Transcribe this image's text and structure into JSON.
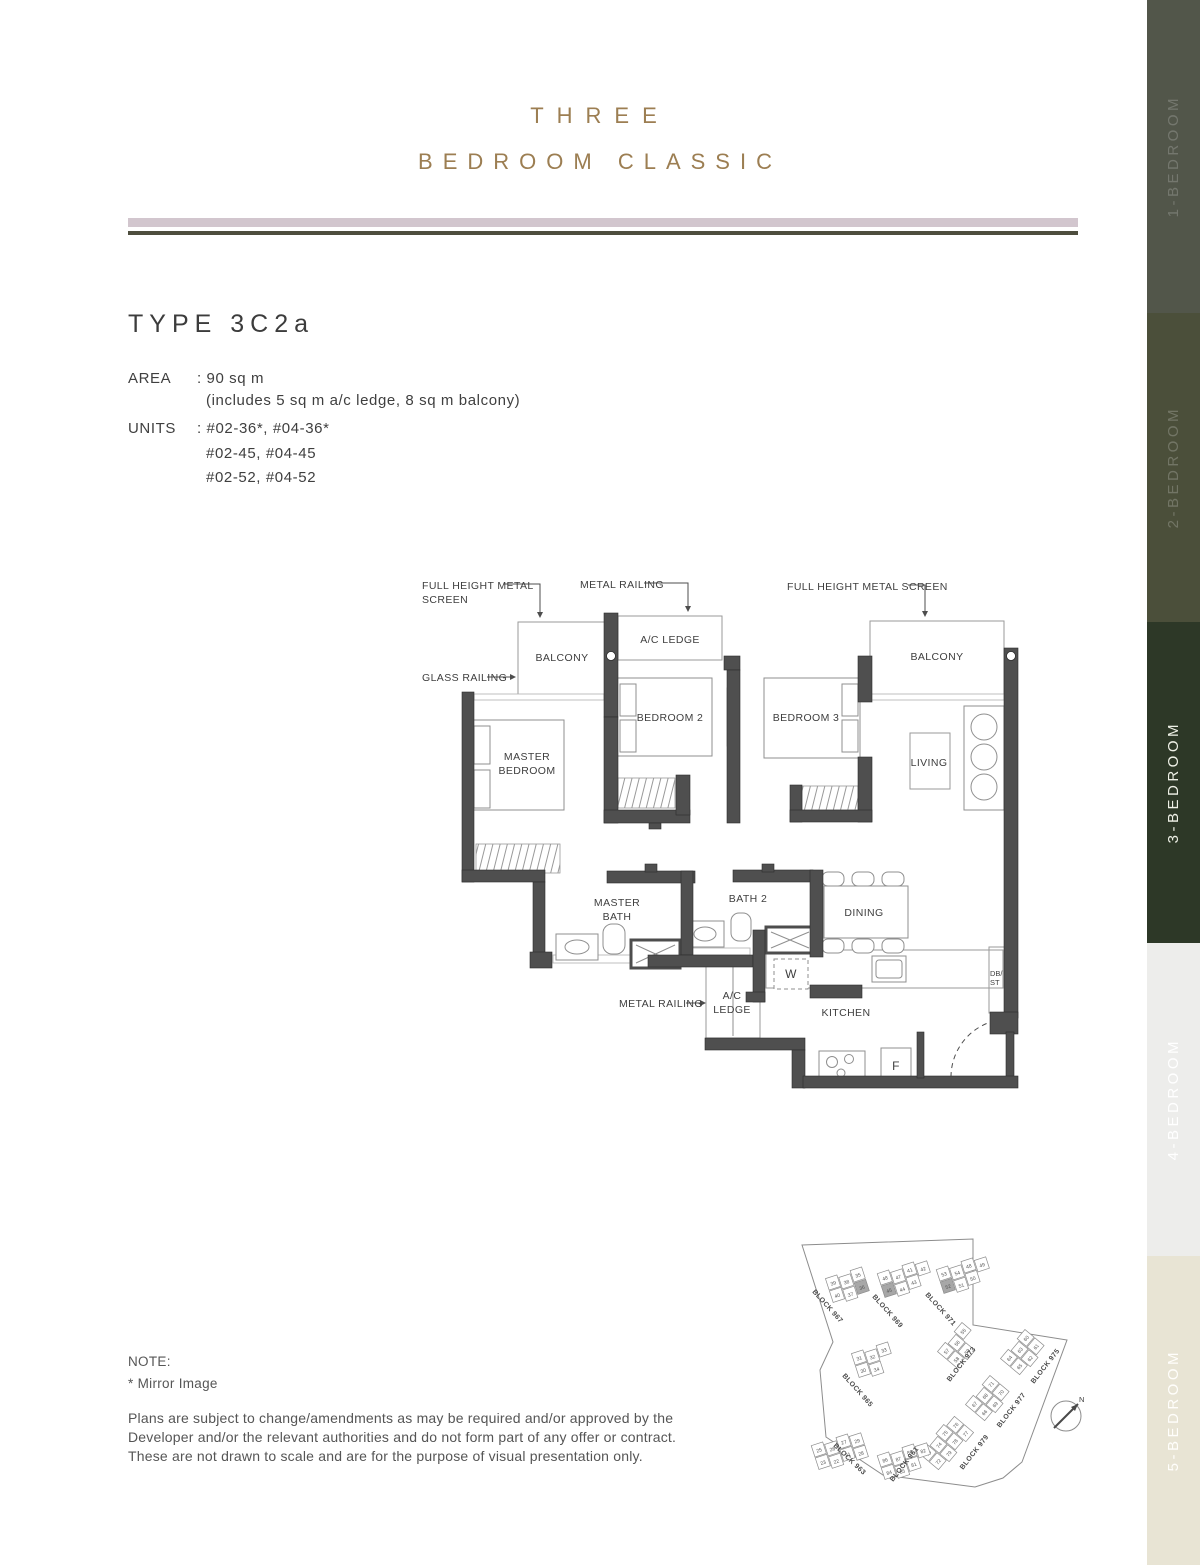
{
  "header": {
    "title_line1": "THREE",
    "title_line2": "BEDROOM CLASSIC",
    "accent_color": "#9c7e52",
    "bar_color": "#d2c6ce",
    "rule_color": "#4e4e3e"
  },
  "unit_info": {
    "type_label": "TYPE 3C2a",
    "area_label": "AREA",
    "area_value": ": 90 sq m",
    "area_note": "(includes 5 sq m a/c ledge, 8 sq m balcony)",
    "units_label": "UNITS",
    "units_line1": ": #02-36*, #04-36*",
    "units_line2": "#02-45, #04-45",
    "units_line3": "#02-52, #04-52"
  },
  "floor_plan": {
    "annotations": {
      "fhms_left_1": "FULL HEIGHT METAL",
      "fhms_left_2": "SCREEN",
      "metal_railing_top": "METAL RAILING",
      "fhms_right": "FULL HEIGHT METAL SCREEN",
      "glass_railing": "GLASS RAILING",
      "metal_railing_bottom": "METAL RAILING"
    },
    "rooms": {
      "balcony_left": "BALCONY",
      "ac_ledge_top": "A/C LEDGE",
      "balcony_right": "BALCONY",
      "bedroom2": "BEDROOM 2",
      "bedroom3": "BEDROOM 3",
      "master_1": "MASTER",
      "master_2": "BEDROOM",
      "living": "LIVING",
      "master_bath_1": "MASTER",
      "master_bath_2": "BATH",
      "bath2": "BATH 2",
      "dining": "DINING",
      "washer": "W",
      "ac_ledge_bottom_1": "A/C",
      "ac_ledge_bottom_2": "LEDGE",
      "kitchen": "KITCHEN",
      "fridge": "F",
      "dbst_1": "DB/",
      "dbst_2": "ST"
    }
  },
  "site_plan": {
    "highlighted_units": [
      "36",
      "45",
      "52"
    ],
    "compass_label": "N",
    "clusters": [
      {
        "label": "BLOCK 967",
        "x": 848,
        "y": 1285,
        "rot": -18,
        "lx": 812,
        "ly": 1292,
        "lrot": 48,
        "units": [
          "39",
          "40",
          "38",
          "37",
          "35",
          "36"
        ],
        "highlight": "36"
      },
      {
        "label": "BLOCK 969",
        "x": 906,
        "y": 1278,
        "rot": -18,
        "lx": 872,
        "ly": 1297,
        "lrot": 48,
        "units": [
          "48",
          "45",
          "47",
          "44",
          "41",
          "43",
          "42"
        ],
        "highlight": "45"
      },
      {
        "label": "BLOCK 971",
        "x": 965,
        "y": 1274,
        "rot": -18,
        "lx": 925,
        "ly": 1295,
        "lrot": 48,
        "units": [
          "53",
          "52",
          "54",
          "51",
          "48",
          "50",
          "49"
        ],
        "highlight": "52"
      },
      {
        "label": "BLOCK 965",
        "x": 874,
        "y": 1360,
        "rot": -18,
        "lx": 842,
        "ly": 1376,
        "lrot": 48,
        "units": [
          "31",
          "30",
          "32",
          "34",
          "33"
        ],
        "highlight": ""
      },
      {
        "label": "BLOCK 973",
        "x": 960,
        "y": 1345,
        "rot": -50,
        "lx": 950,
        "ly": 1382,
        "lrot": -52,
        "units": [
          "57",
          "58",
          "56",
          "59",
          "55"
        ],
        "highlight": ""
      },
      {
        "label": "BLOCK 975",
        "x": 1023,
        "y": 1352,
        "rot": -50,
        "lx": 1034,
        "ly": 1384,
        "lrot": -52,
        "units": [
          "64",
          "65",
          "63",
          "62",
          "60",
          "61"
        ],
        "highlight": ""
      },
      {
        "label": "BLOCK 977",
        "x": 988,
        "y": 1398,
        "rot": -50,
        "lx": 1000,
        "ly": 1428,
        "lrot": -52,
        "units": [
          "67",
          "66",
          "68",
          "69",
          "71",
          "70"
        ],
        "highlight": ""
      },
      {
        "label": "BLOCK 979",
        "x": 946,
        "y": 1442,
        "rot": -50,
        "lx": 963,
        "ly": 1470,
        "lrot": -52,
        "units": [
          "73",
          "72",
          "74",
          "79",
          "75",
          "78",
          "76",
          "77"
        ],
        "highlight": ""
      },
      {
        "label": "BLOCK 961",
        "x": 906,
        "y": 1460,
        "rot": -18,
        "lx": 893,
        "ly": 1482,
        "lrot": -52,
        "units": [
          "86",
          "84",
          "87",
          "85",
          "80",
          "81",
          "82"
        ],
        "highlight": ""
      },
      {
        "label": "BLOCK 963",
        "x": 840,
        "y": 1450,
        "rot": -18,
        "lx": 833,
        "ly": 1446,
        "lrot": 44,
        "units": [
          "25",
          "23",
          "26",
          "22",
          "27",
          "21",
          "29",
          "28"
        ],
        "highlight": ""
      }
    ]
  },
  "note": {
    "heading": "NOTE:",
    "mirror": "*   Mirror Image",
    "disclaimer_line1": "Plans are subject to change/amendments as may be required and/or approved by the",
    "disclaimer_line2": "Developer and/or the relevant authorities and do not form part of any offer or contract.",
    "disclaimer_line3": "These are not drawn to scale and are for the purpose of visual presentation only."
  },
  "sidebar": {
    "items": [
      {
        "label": "1-BEDROOM",
        "bg": "#52564a",
        "fg": "rgba(255,255,255,0.20)",
        "active": false
      },
      {
        "label": "2-BEDROOM",
        "bg": "#4b4f3a",
        "fg": "rgba(255,255,255,0.22)",
        "active": false
      },
      {
        "label": "3-BEDROOM",
        "bg": "#2d3827",
        "fg": "#eef0e6",
        "active": true
      },
      {
        "label": "4-BEDROOM",
        "bg": "#ededeb",
        "fg": "#ffffff",
        "active": false
      },
      {
        "label": "5-BEDROOM",
        "bg": "#e8e4d4",
        "fg": "#fffefb",
        "active": false
      }
    ]
  }
}
